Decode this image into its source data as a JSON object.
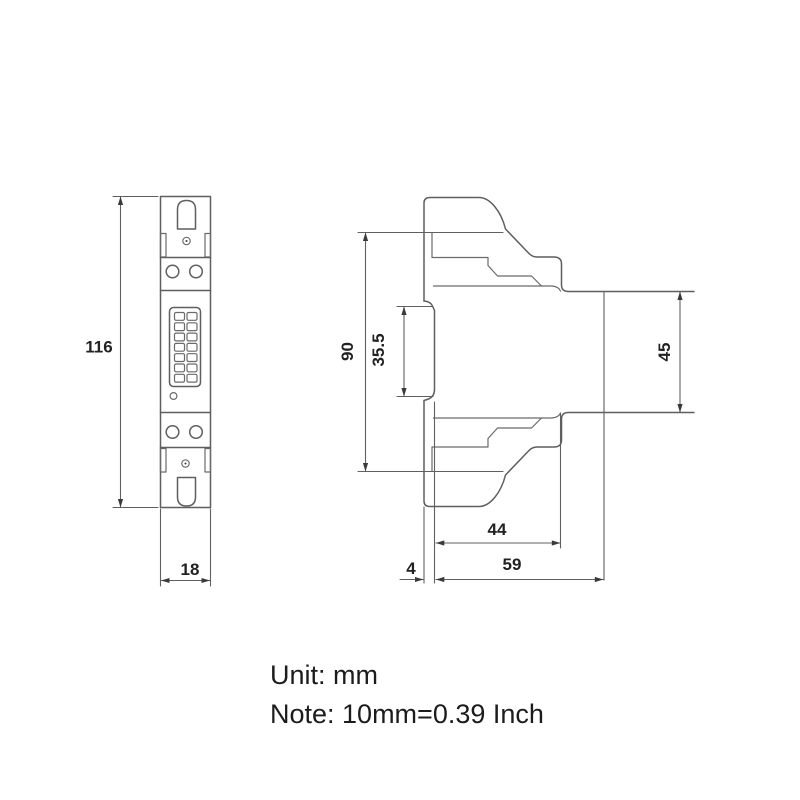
{
  "drawing": {
    "dimensions": {
      "front_height": "116",
      "front_width": "18",
      "side_height_total": "90",
      "din_slot_height": "35.5",
      "module_height": "45",
      "depth_upper": "44",
      "depth_total": "59",
      "rail_offset": "4"
    },
    "notes": {
      "unit": "Unit: mm",
      "conversion": "Note: 10mm=0.39 Inch"
    },
    "colors": {
      "background": "#ffffff",
      "line": "#5f5f5f",
      "text": "#222222"
    }
  }
}
